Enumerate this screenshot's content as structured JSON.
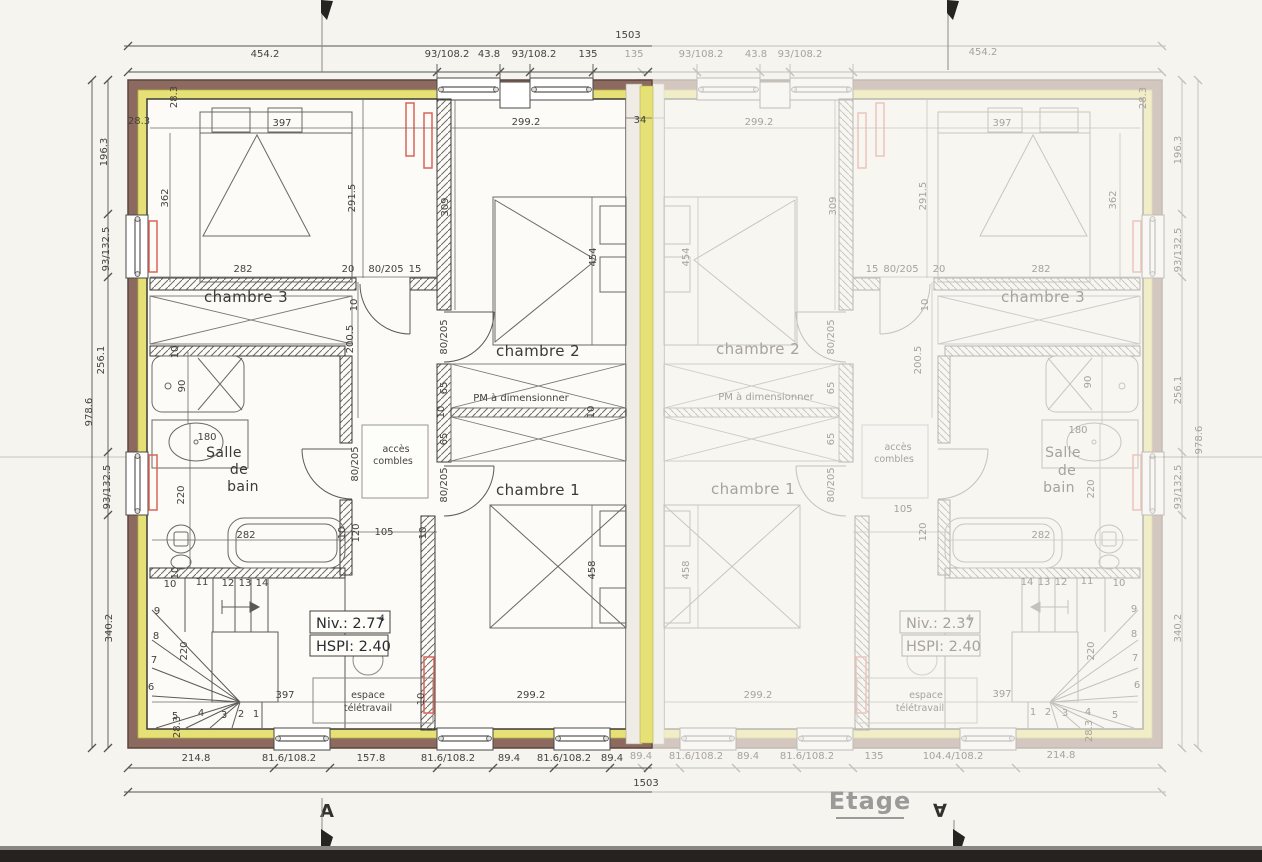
{
  "page": {
    "title": "Etage",
    "section_a": "A",
    "section_a_inverted": "∀"
  },
  "overall_dims": {
    "width": "1503",
    "height": "978.6"
  },
  "chains": {
    "top_left": [
      "454.2",
      "93/108.2",
      "43.8",
      "93/108.2",
      "135"
    ],
    "top_right": [
      "135",
      "93/108.2",
      "43.8",
      "93/108.2",
      "454.2"
    ],
    "bottom_left": [
      "214.8",
      "81.6/108.2",
      "157.8",
      "81.6/108.2",
      "89.4",
      "81.6/108.2",
      "89.4"
    ],
    "bottom_right": [
      "89.4",
      "81.6/108.2",
      "89.4",
      "81.6/108.2",
      "135",
      "104.4/108.2",
      "214.8"
    ],
    "side": [
      "28.3",
      "196.3",
      "93/132.5",
      "256.1",
      "93/132.5",
      "340.2",
      "28.3"
    ]
  },
  "dims": {
    "d397": "397",
    "d362": "362",
    "d2915": "291.5",
    "d282": "282",
    "d20": "20",
    "d80205": "80/205",
    "d15": "15",
    "d10": "10",
    "d2992": "299.2",
    "d34": "34",
    "d309": "309",
    "d454": "454",
    "d2005": "200.5",
    "d65": "65",
    "d90": "90",
    "d180": "180",
    "d220": "220",
    "d105": "105",
    "d120": "120",
    "d458": "458"
  },
  "rooms": {
    "chambre1": "chambre 1",
    "chambre2": "chambre 2",
    "chambre3": "chambre 3",
    "salle": "Salle",
    "de": "de",
    "bain": "bain",
    "acces": "accès",
    "combles": "combles",
    "espace": "espace",
    "teletravail": "télétravail",
    "pm": "PM à dimensionner"
  },
  "levels": {
    "left": {
      "niv": "Niv.: 2.77",
      "sup": "4",
      "hspi": "HSPI: 2.40"
    },
    "right": {
      "niv": "Niv.: 2.37",
      "sup": "4",
      "hspi": "HSPI: 2.40"
    }
  },
  "stairs": {
    "n1": "1",
    "n2": "2",
    "n3": "3",
    "n4": "4",
    "n5": "5",
    "n6": "6",
    "n7": "7",
    "n8": "8",
    "n9": "9",
    "n10": "10",
    "n11": "11",
    "n12": "12",
    "n13": "13",
    "n14": "14"
  }
}
